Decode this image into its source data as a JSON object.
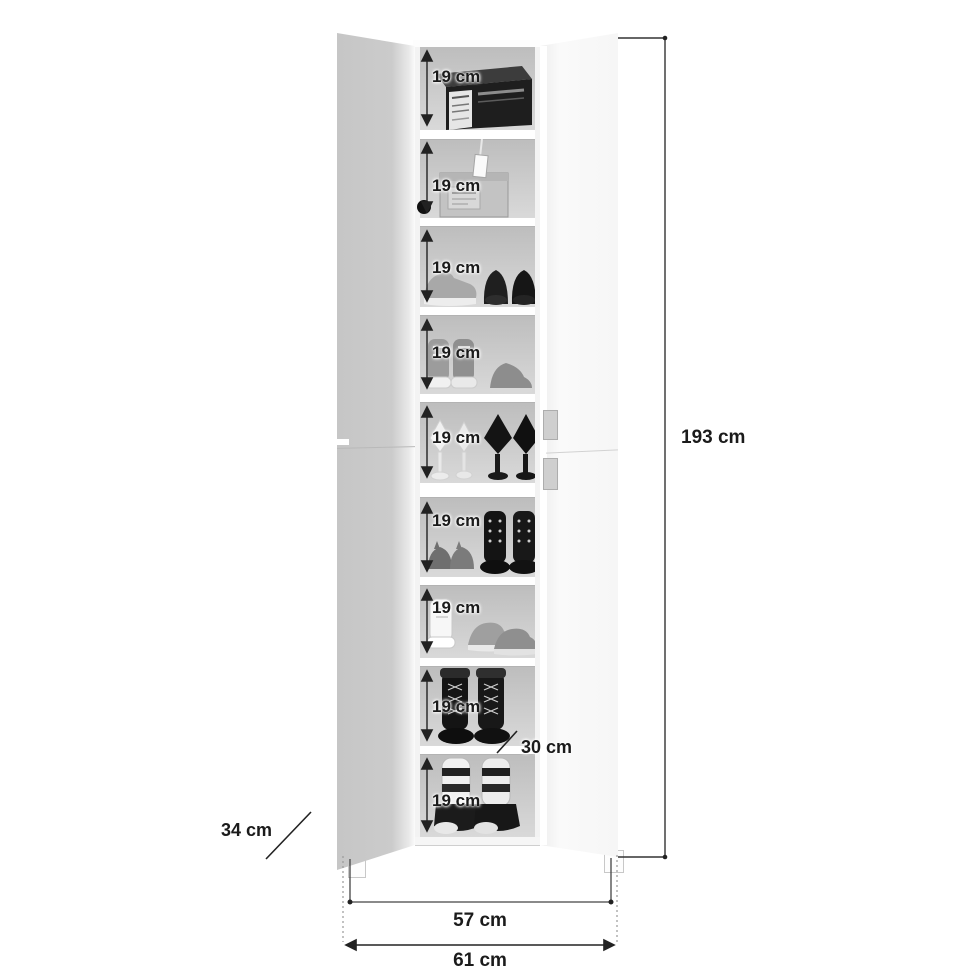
{
  "diagram": {
    "title": "shoe cabinet dimension diagram",
    "dimensions": {
      "total_height": "193 cm",
      "inner_width": "57 cm",
      "total_width": "61 cm",
      "depth": "34 cm",
      "shelf_depth": "30 cm"
    },
    "compartments": [
      {
        "label": "19 cm",
        "content": "black shoe box"
      },
      {
        "label": "19 cm",
        "content": "plastic storage box with hanging tag"
      },
      {
        "label": "19 cm",
        "content": "sneaker and black dress shoes"
      },
      {
        "label": "19 cm",
        "content": "high-top sneakers and flat"
      },
      {
        "label": "19 cm",
        "content": "white and black high heels"
      },
      {
        "label": "19 cm",
        "content": "flats and lace-up ankle boots"
      },
      {
        "label": "19 cm",
        "content": "white high-top and running shoes"
      },
      {
        "label": "19 cm",
        "content": "black lace-up boots"
      },
      {
        "label": "19 cm",
        "content": "wedge sneaker boots"
      }
    ],
    "colors": {
      "line": "#222222",
      "interior_back": "#cccccc",
      "left_door": "#c9c9c9",
      "right_door": "#f7f7f7",
      "shelf": "#ffffff"
    }
  }
}
